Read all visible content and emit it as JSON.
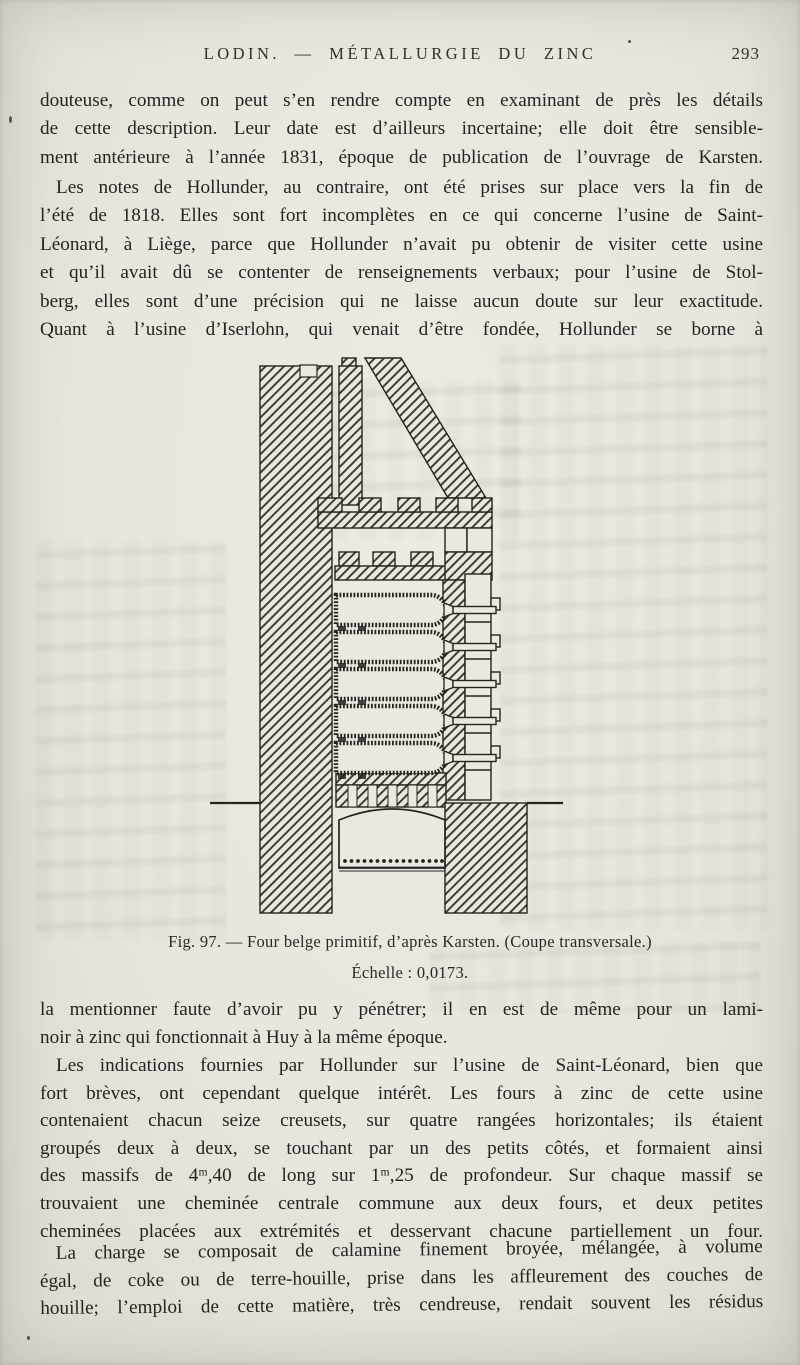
{
  "colors": {
    "paper": "#e8e5de",
    "ink": "#26241f"
  },
  "header": {
    "title": "LODIN. — MÉTALLURGIE DU ZINC",
    "page_number": "293"
  },
  "paragraphs": [
    {
      "indent": false,
      "ragged_last": false,
      "lines": [
        "douteuse, comme on peut s’en rendre compte en examinant de près les détails",
        "de cette description. Leur date est d’ailleurs incertaine; elle doit être sensible-",
        "ment antérieure à l’année 1831, époque de publication de l’ouvrage de Karsten."
      ]
    },
    {
      "indent": true,
      "ragged_last": false,
      "lines": [
        "Les notes de Hollunder, au contraire, ont été prises sur place vers la fin de",
        "l’été de 1818. Elles sont fort incomplètes en ce qui concerne l’usine de Saint-",
        "Léonard, à Liège, parce que Hollunder n’avait pu obtenir de visiter cette usine",
        "et qu’il avait dû se contenter de renseignements verbaux; pour l’usine de Stol-",
        "berg, elles sont d’une précision qui ne laisse aucun doute sur leur exactitude.",
        "Quant à l’usine d’Iserlohn, qui venait d’être fondée, Hollunder se borne à"
      ]
    },
    {
      "indent": false,
      "ragged_last": true,
      "lines": [
        "la mentionner faute d’avoir pu y pénétrer; il en est de même pour un lami-",
        "noir à zinc qui fonctionnait à Huy à la même époque."
      ]
    },
    {
      "indent": true,
      "ragged_last": false,
      "lines": [
        "Les indications fournies par Hollunder sur l’usine de Saint-Léonard, bien que",
        "fort brèves, ont cependant quelque intérêt. Les fours à zinc de cette usine",
        "contenaient chacun seize creusets, sur quatre rangées horizontales; ils étaient",
        "groupés deux à deux, se touchant par un des petits côtés, et formaient ainsi",
        "des massifs de 4ᵐ,40 de long sur 1ᵐ,25 de profondeur. Sur chaque massif se",
        "trouvaient une cheminée centrale commune aux deux fours, et deux petites",
        "cheminées placées aux extrémités et desservant chacune partiellement un four."
      ]
    },
    {
      "indent": true,
      "ragged_last": false,
      "lines": [
        "La charge se composait de calamine finement broyée, mélangée, à volume",
        "égal, de coke ou de terre-houille, prise dans les affleurement des couches de",
        "houille; l’emploi de cette matière, très cendreuse, rendait souvent les résidus"
      ]
    }
  ],
  "figure": {
    "caption": "Fig. 97. — Four belge primitif, d’après Karsten. (Coupe transversale.)",
    "scale": "Échelle : 0,0173."
  }
}
